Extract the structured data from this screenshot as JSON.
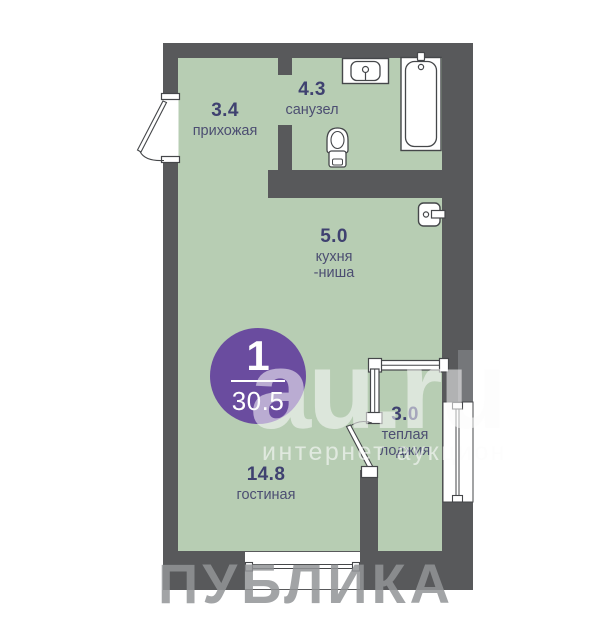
{
  "plan": {
    "rooms": [
      {
        "id": "hallway",
        "area": "3.4",
        "line1": "прихожая"
      },
      {
        "id": "bathroom",
        "area": "4.3",
        "line1": "санузел"
      },
      {
        "id": "kitchen",
        "area": "5.0",
        "line1": "кухня",
        "line2": "-ниша"
      },
      {
        "id": "loggia",
        "area": "3.0",
        "line1": "теплая",
        "line2": "лоджия"
      },
      {
        "id": "living",
        "area": "14.8",
        "line1": "гостиная"
      }
    ],
    "badge": {
      "rooms_count": "1",
      "total_area": "30.5"
    }
  },
  "watermarks": {
    "site": "au.ru",
    "site_tagline": "интернет аукцион",
    "developer": "ПУБЛИКА"
  },
  "colors": {
    "wall": "#58595b",
    "floor": "#b7cdb3",
    "badge": "#6a4c9f",
    "label_text": "#3f4170",
    "fixture_outline": "#45474a"
  }
}
